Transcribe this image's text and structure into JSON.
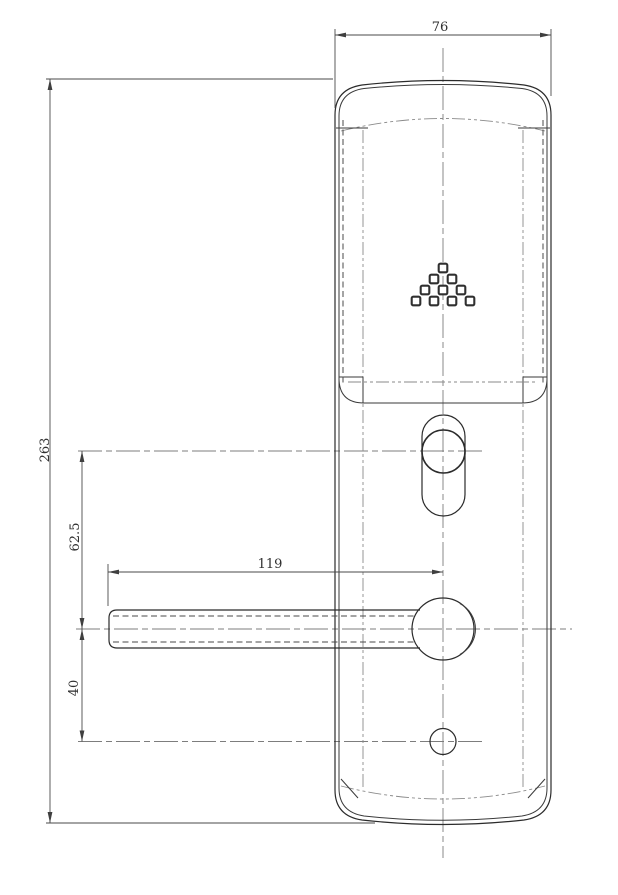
{
  "drawing": {
    "dimensions": {
      "plate_width": "76",
      "overall_height": "263",
      "cylinder_to_handle": "62.5",
      "handle_to_keyhole": "40",
      "handle_length": "119"
    },
    "colors": {
      "line": "#2b2b2b",
      "centerline": "#7d7d7d",
      "dimension": "#4a4a4a",
      "background": "#ffffff"
    }
  }
}
